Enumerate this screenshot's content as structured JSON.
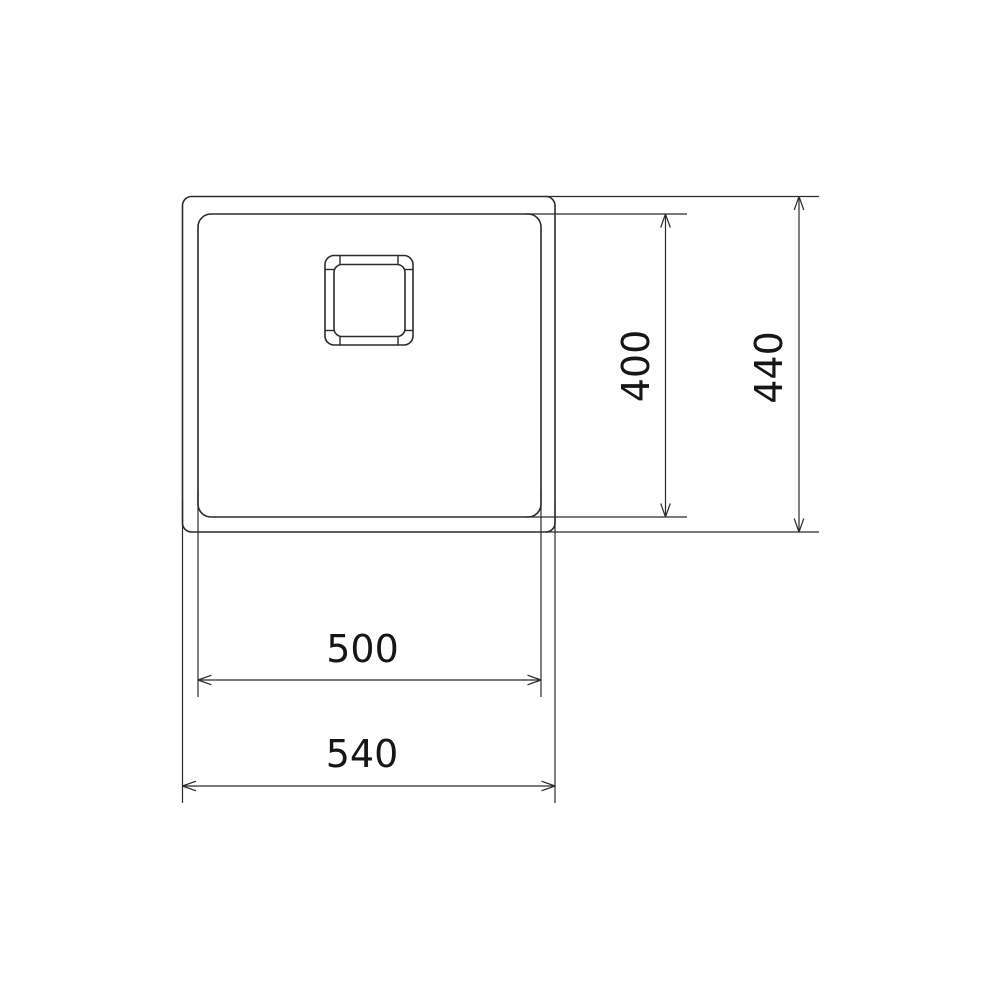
{
  "drawing": {
    "name": "sink-dimension-drawing",
    "canvas": {
      "width": 1000,
      "height": 1000
    },
    "colors": {
      "background": "#ffffff",
      "line": "#2b2b2b",
      "text": "#161616"
    },
    "stroke": {
      "shape_width": 1.6,
      "detail_width": 1.4,
      "dim_width": 1.2
    },
    "font_size": 38,
    "arrow": {
      "length": 13.5,
      "half_width": 4.8
    },
    "shapes": [
      {
        "name": "sink-outer-rim",
        "x": 182.5,
        "y": 196.5,
        "width": 372.5,
        "height": 335.5,
        "rx": 9
      },
      {
        "name": "sink-bowl",
        "x": 198,
        "y": 214,
        "width": 343,
        "height": 303,
        "rx": 13
      },
      {
        "name": "drain-outer",
        "x": 325,
        "y": 255.5,
        "width": 88,
        "height": 89.5,
        "rx": 9
      },
      {
        "name": "drain-inner",
        "x": 334,
        "y": 264.5,
        "width": 71,
        "height": 72,
        "rx": 8
      }
    ],
    "detail_lines": [
      {
        "name": "drain-tick-top-left",
        "x1": 340,
        "y1": 255.5,
        "x2": 340,
        "y2": 264.5
      },
      {
        "name": "drain-tick-top-right",
        "x1": 398,
        "y1": 255.5,
        "x2": 398,
        "y2": 264.5
      },
      {
        "name": "drain-tick-bottom-left",
        "x1": 340,
        "y1": 336.5,
        "x2": 340,
        "y2": 345
      },
      {
        "name": "drain-tick-bottom-right",
        "x1": 398,
        "y1": 336.5,
        "x2": 398,
        "y2": 345
      },
      {
        "name": "drain-tick-left-upper",
        "x1": 325,
        "y1": 269.5,
        "x2": 334,
        "y2": 269.5
      },
      {
        "name": "drain-tick-left-lower",
        "x1": 325,
        "y1": 330.5,
        "x2": 334,
        "y2": 330.5
      },
      {
        "name": "drain-tick-right-upper",
        "x1": 405,
        "y1": 269.5,
        "x2": 413,
        "y2": 269.5
      },
      {
        "name": "drain-tick-right-lower",
        "x1": 405,
        "y1": 330.5,
        "x2": 413,
        "y2": 330.5
      }
    ],
    "extension_lines": [
      {
        "name": "ext-400-top",
        "x1": 525,
        "y1": 214,
        "x2": 687,
        "y2": 214
      },
      {
        "name": "ext-400-bottom",
        "x1": 525,
        "y1": 517,
        "x2": 687,
        "y2": 517
      },
      {
        "name": "ext-440-top",
        "x1": 545,
        "y1": 196.5,
        "x2": 819,
        "y2": 196.5
      },
      {
        "name": "ext-440-bottom",
        "x1": 545,
        "y1": 532,
        "x2": 819,
        "y2": 532
      },
      {
        "name": "ext-500-left",
        "x1": 198,
        "y1": 490,
        "x2": 198,
        "y2": 697
      },
      {
        "name": "ext-500-right",
        "x1": 541,
        "y1": 490,
        "x2": 541,
        "y2": 697
      },
      {
        "name": "ext-540-left",
        "x1": 182.5,
        "y1": 502,
        "x2": 182.5,
        "y2": 803
      },
      {
        "name": "ext-540-right",
        "x1": 555,
        "y1": 502,
        "x2": 555,
        "y2": 803
      }
    ],
    "dimensions": [
      {
        "name": "dim-bowl-height",
        "value": "400",
        "orientation": "vertical",
        "line": {
          "x": 665.5,
          "y1": 214,
          "y2": 517
        },
        "label": {
          "cx": 635.5,
          "cy": 366,
          "rotation": -90
        }
      },
      {
        "name": "dim-overall-height",
        "value": "440",
        "orientation": "vertical",
        "line": {
          "x": 799,
          "y1": 196.5,
          "y2": 532
        },
        "label": {
          "cx": 768.5,
          "cy": 367.5,
          "rotation": -90
        }
      },
      {
        "name": "dim-bowl-width",
        "value": "500",
        "orientation": "horizontal",
        "line": {
          "y": 680,
          "x1": 198,
          "x2": 541
        },
        "label": {
          "cx": 362.5,
          "cy": 648.5,
          "rotation": 0
        }
      },
      {
        "name": "dim-overall-width",
        "value": "540",
        "orientation": "horizontal",
        "line": {
          "y": 786,
          "x1": 182.5,
          "x2": 555
        },
        "label": {
          "cx": 362,
          "cy": 753.5,
          "rotation": 0
        }
      }
    ]
  }
}
